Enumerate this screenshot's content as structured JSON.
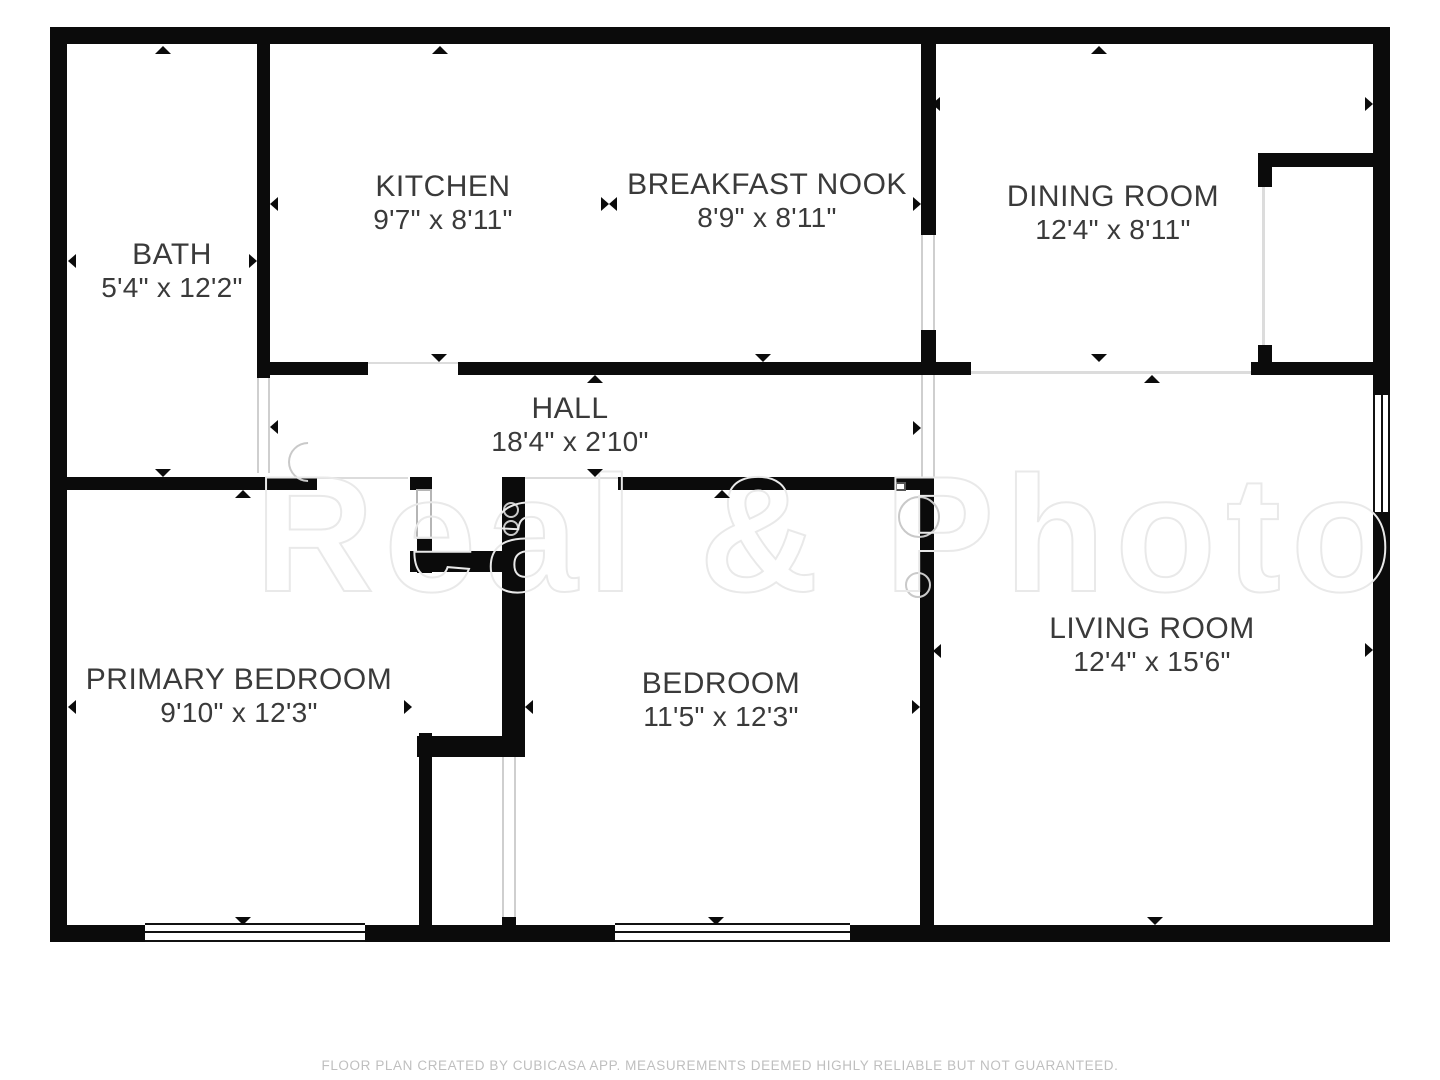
{
  "rooms": [
    {
      "name": "BATH",
      "dims": "5'4\" x 12'2\""
    },
    {
      "name": "KITCHEN",
      "dims": "9'7\" x 8'11\""
    },
    {
      "name": "BREAKFAST NOOK",
      "dims": "8'9\" x 8'11\""
    },
    {
      "name": "DINING ROOM",
      "dims": "12'4\" x 8'11\""
    },
    {
      "name": "HALL",
      "dims": "18'4\" x 2'10\""
    },
    {
      "name": "PRIMARY BEDROOM",
      "dims": "9'10\" x 12'3\""
    },
    {
      "name": "BEDROOM",
      "dims": "11'5\" x 12'3\""
    },
    {
      "name": "LIVING ROOM",
      "dims": "12'4\" x 15'6\""
    }
  ],
  "watermark": {
    "text": "Real & Photo"
  },
  "footer": {
    "disclaimer": "FLOOR PLAN CREATED BY CUBICASA APP. MEASUREMENTS DEEMED HIGHLY RELIABLE BUT NOT GUARANTEED."
  },
  "colors": {
    "wall": "#0b0b0b",
    "label": "#3a3a3a",
    "footer": "#bfbfbf",
    "watermark": "#e9e9e9",
    "symbol": "#c9c9c9"
  }
}
